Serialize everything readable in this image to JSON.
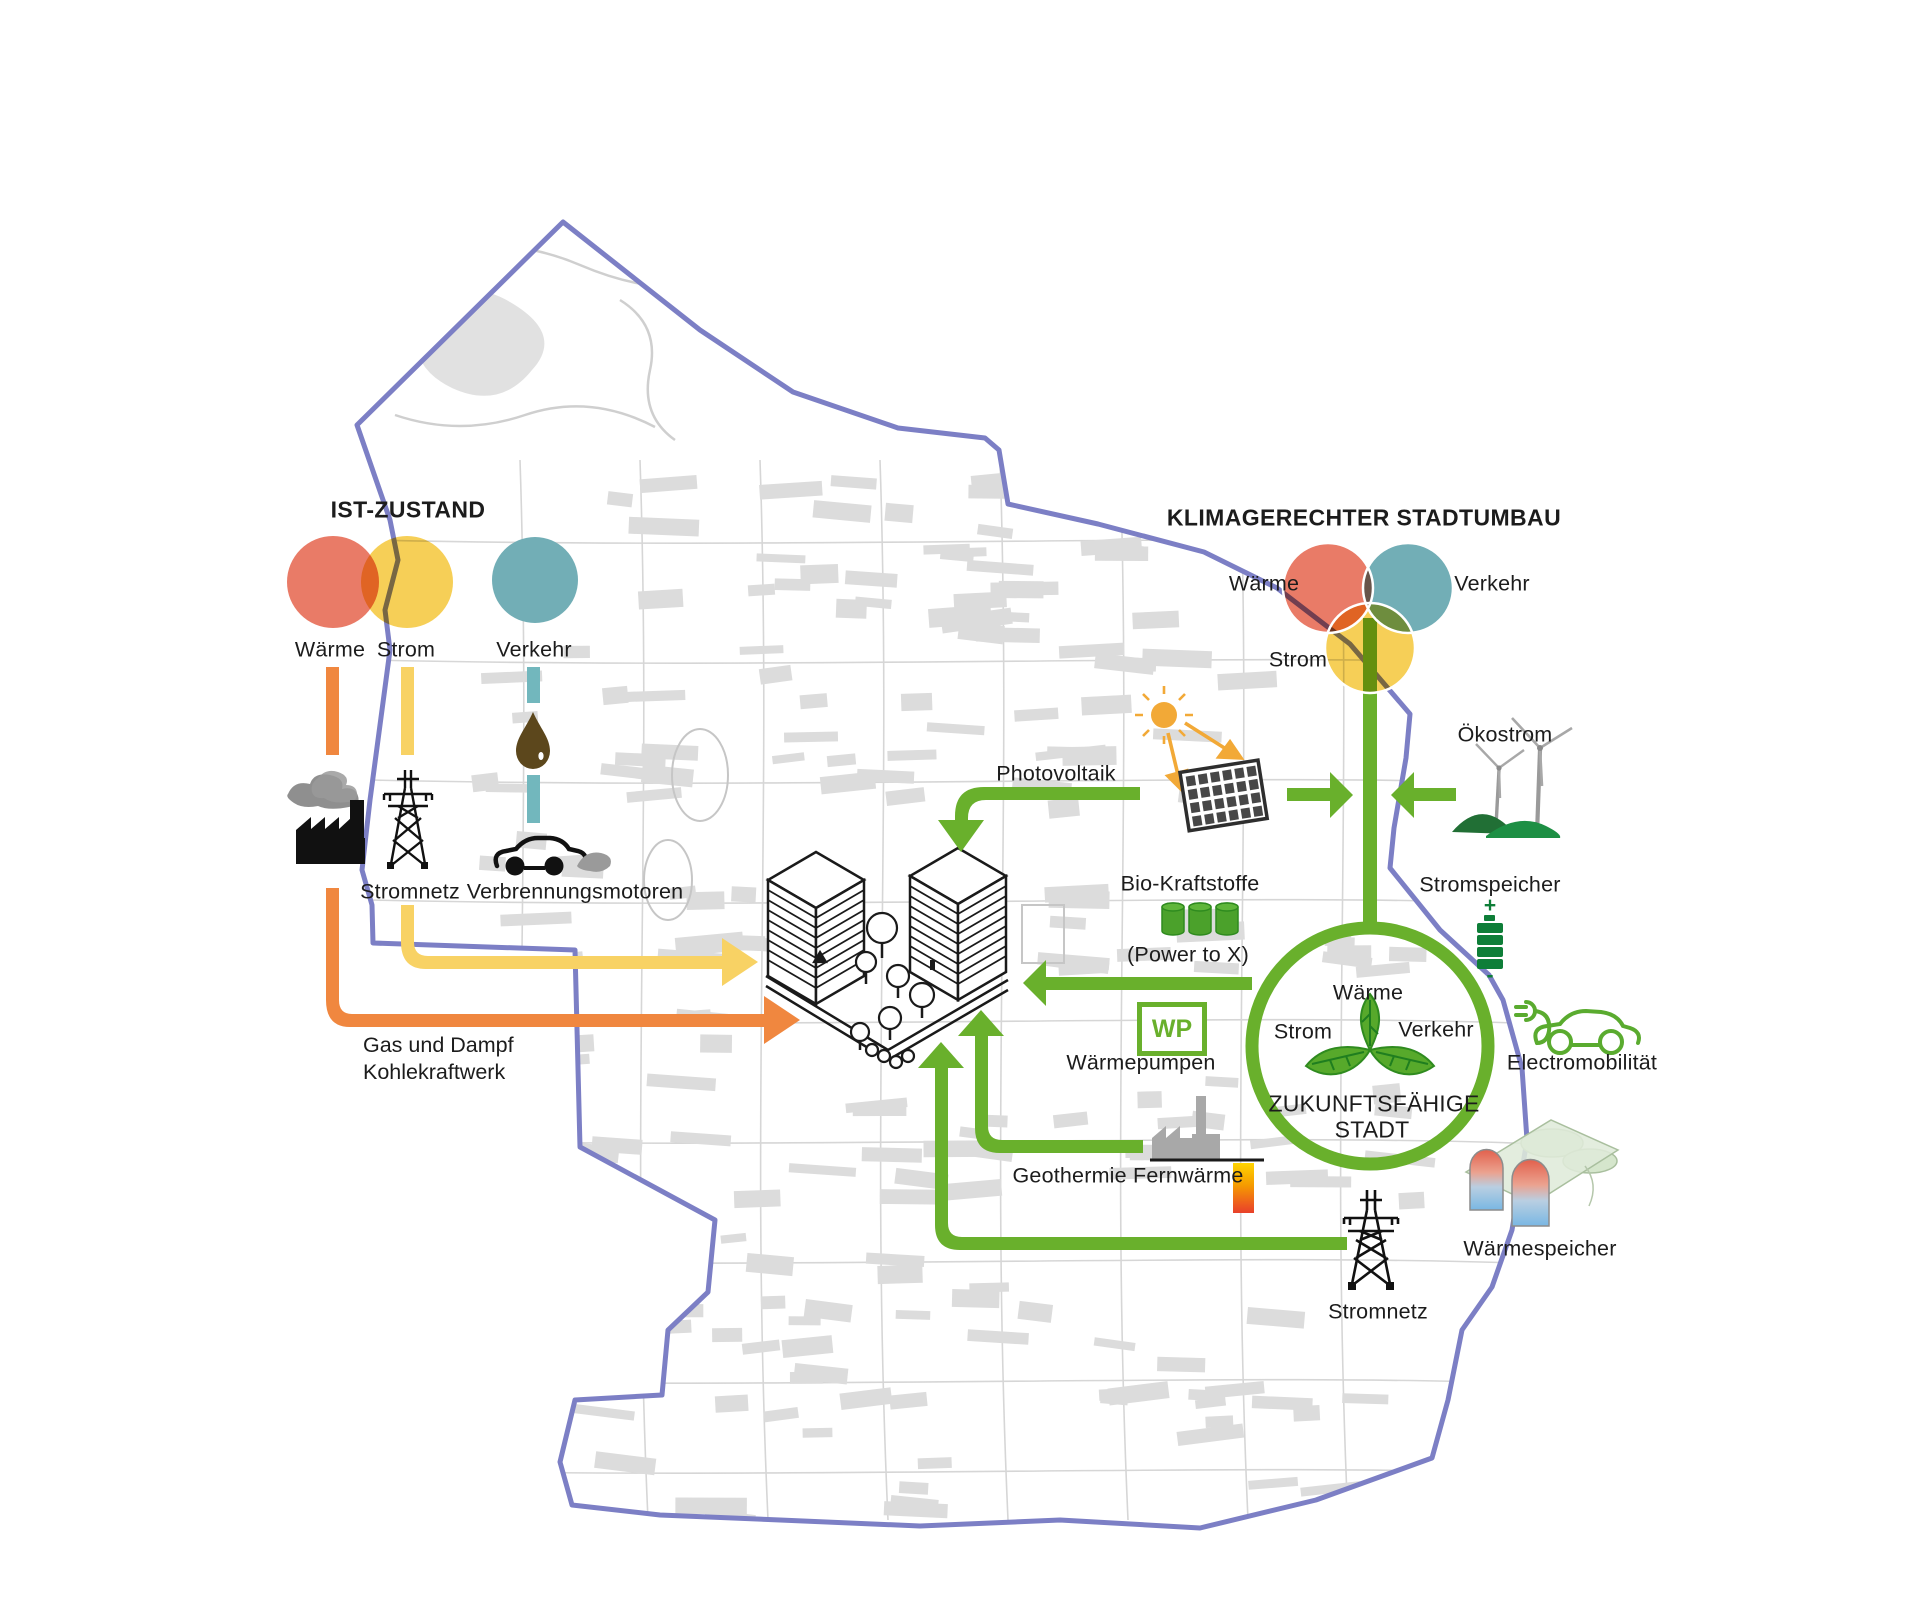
{
  "ist": {
    "heading": "IST-ZUSTAND",
    "circles": [
      {
        "label": "Wärme",
        "color": "#e97b67"
      },
      {
        "label": "Strom",
        "color": "#f6cf57"
      },
      {
        "label": "Verkehr",
        "color": "#72aeb6"
      }
    ],
    "stromnetz_label": "Stromnetz",
    "verbrennung_label": "Verbrennungsmotoren",
    "kraftwerk_line1": "Gas und Dampf",
    "kraftwerk_line2": "Kohlekraftwerk"
  },
  "klima": {
    "heading": "KLIMAGERECHTER STADTUMBAU",
    "venn": [
      {
        "label": "Wärme",
        "color": "#e97b67"
      },
      {
        "label": "Verkehr",
        "color": "#72aeb6"
      },
      {
        "label": "Strom",
        "color": "#f6cf57"
      }
    ],
    "oekostrom": "Ökostrom",
    "photovoltaik": "Photovoltaik",
    "bio_kraftstoffe": "Bio-Kraftstoffe",
    "power_to_x": "(Power to X)",
    "wp_label": "WP",
    "waermepumpen": "Wärmepumpen",
    "geothermie": "Geothermie Fernwärme",
    "stromspeicher": "Stromspeicher",
    "battery_plus": "+",
    "battery_minus": "-",
    "electromobilitaet": "Electromobilität",
    "waermespeicher": "Wärmespeicher",
    "stromnetz_label": "Stromnetz",
    "city_circle": {
      "top": "Wärme",
      "left": "Strom",
      "right": "Verkehr",
      "line1": "ZUKUNFTSFÄHIGE",
      "line2": "STADT"
    }
  },
  "colors": {
    "heat_red": "#e97b67",
    "electricity_yellow": "#f6cf57",
    "transport_teal": "#72aeb6",
    "heat_arrow_orange": "#f0873f",
    "electricity_arrow_yellow": "#f8d264",
    "green_accent": "#69b02c",
    "dark_green": "#0e7e38",
    "district_boundary_purple": "#7c7fc5",
    "oil_brown": "#5c471c",
    "map_gray": "#dcdcdc"
  },
  "icons": {
    "coal_plant": "factory-with-smoke-icon",
    "pylon": "transmission-tower-icon",
    "combustion_car": "car-icon",
    "oil": "oil-drop-icon",
    "sun": "sun-icon",
    "solar_panel": "solar-panel-icon",
    "wind": "wind-turbines-icon",
    "battery": "battery-icon",
    "ecar": "electric-car-plug-icon",
    "heat_storage": "underground-heat-storage-icon",
    "leaf": "leaf-trefoil-icon",
    "geothermal": "geothermal-plant-icon",
    "towers": "city-towers-icon"
  }
}
